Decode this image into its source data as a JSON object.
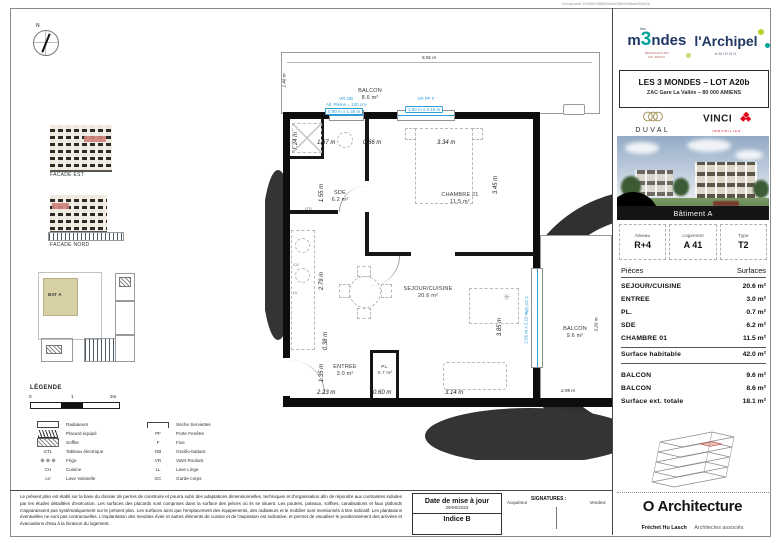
{
  "doc_ref": "Docaposte 209d9e2f8866/e6c0f8e99e8a8d93d2b",
  "branding": {
    "mondes_prefix": "m",
    "mondes_digit": "3",
    "mondes_suffix": "ndes",
    "mondes_les": "les",
    "mondes_tagline1": "DESTINATION",
    "mondes_tagline2": "DU M3CO",
    "archipel": "l'Archipel",
    "archipel_city": "AMIENS",
    "duval": "DUVAL",
    "vinci": "VINCI",
    "vinci_sub": "IMMOBILIER"
  },
  "title_block": {
    "line1": "LES 3 MONDES – LOT A20b",
    "line2": "ZAC Gare La Vallée – 80 000 AMIENS"
  },
  "photo": {
    "caption": "Bâtiment A"
  },
  "unit": {
    "headers": [
      "Niveau",
      "Logement",
      "Type"
    ],
    "values": [
      "R+4",
      "A 41",
      "T2"
    ]
  },
  "surfaces": {
    "header_left": "Pièces",
    "header_right": "Surfaces",
    "rows": [
      {
        "label": "SEJOUR/CUISINE",
        "value": "20.6 m²"
      },
      {
        "label": "ENTREE",
        "value": "3.0 m²"
      },
      {
        "label": "PL.",
        "value": "0.7 m²"
      },
      {
        "label": "SDE",
        "value": "6.2 m²"
      },
      {
        "label": "CHAMBRE 01",
        "value": "11.5 m²"
      }
    ],
    "total": {
      "label": "Surface habitable",
      "value": "42.0 m²"
    },
    "ext_rows": [
      {
        "label": "BALCON",
        "value": "9.6 m²"
      },
      {
        "label": "BALCON",
        "value": "8.6 m²"
      }
    ],
    "ext_total": {
      "label": "Surface ext. totale",
      "value": "18.1 m²"
    }
  },
  "plan": {
    "rooms": {
      "balcon_top": {
        "name": "BALCON",
        "area": "8.6 m²"
      },
      "sde": {
        "name": "SDE",
        "area": "6.2 m²"
      },
      "chambre": {
        "name": "CHAMBRE 01",
        "area": "11.5 m²"
      },
      "sejour": {
        "name": "SEJOUR/CUISINE",
        "area": "20.6 m²"
      },
      "entree": {
        "name": "ENTREE",
        "area": "3.0 m²"
      },
      "placard": {
        "name": "PL.",
        "area": "0.7 m²"
      },
      "balcon_right": {
        "name": "BALCON",
        "area": "9.6 m²"
      }
    },
    "dims": {
      "balcon_top_w": "5.91 m",
      "balcon_top_d": "1.46 m",
      "sde_w": "1.87 m",
      "hall_w": "0.66 m",
      "chambre_w": "3.34 m",
      "bath_w": "1.24 m",
      "sde_h": "1.55 m",
      "chambre_h": "3.45 m",
      "kitchen_h": "2.79 m",
      "mid_h": "0.38 m",
      "entree_h": "1.35 m",
      "entree_w": "2.23 m",
      "pl_w": "0.60 m",
      "sejour_w": "3.14 m",
      "sejour_h": "3.85 m",
      "balcon_right_h": "3.26 m",
      "balcon_right_w": "2.95 m"
    },
    "windows": {
      "w1_codes": "VR OB",
      "w1_allege": "All. Pleine = 100 cm",
      "w1_size": "0.90 m x 1.35 m",
      "w2_codes": "VR PF F",
      "w2_size": "1.80 m x 2.15 m",
      "w3_codes": "VR PF F",
      "w3_size": "2.05 m x 2.15 m"
    },
    "labels": {
      "gtl": "GTL",
      "cu": "CU",
      "lv": "LV"
    }
  },
  "left_panel": {
    "compass_n": "N",
    "facade_est": "FACADE EST",
    "facade_nord": "FACADE NORD",
    "site_building": "BAT A"
  },
  "legend": {
    "title": "LÉGENDE",
    "scale": {
      "zero": "0",
      "one": "1",
      "two": "2m"
    },
    "frigo_symbol": "⊛ ⊛ ⊛",
    "left": [
      {
        "code": "",
        "label": "Radiateurs"
      },
      {
        "code": "",
        "label": "Placard équipé"
      },
      {
        "code": "",
        "label": "Soffite"
      },
      {
        "code": "GTL",
        "label": "Tableau électrique"
      },
      {
        "code": "",
        "label": "Frigo"
      },
      {
        "code": "CU",
        "label": "Cuisine"
      },
      {
        "code": "LV",
        "label": "Lave Vaisselle"
      }
    ],
    "right": [
      {
        "code": "",
        "label": "Sèche Serviettes"
      },
      {
        "code": "PF",
        "label": "Porte Fenêtre"
      },
      {
        "code": "F",
        "label": "Fixe"
      },
      {
        "code": "OB",
        "label": "Oscillo-battant"
      },
      {
        "code": "VR",
        "label": "Volet Roulant"
      },
      {
        "code": "LL",
        "label": "Lave Linge"
      },
      {
        "code": "GC",
        "label": "Garde-corps"
      }
    ]
  },
  "footer": {
    "legal": "Le présent plan est établi sur la base du dossier de permis de construire et pourra subir des adaptations dimensionnelles, techniques et d'organisation afin de répondre aux contraintes induites par les études détaillées d'exécution. Les surfaces des placards sont comprises dans la surface des pièces où ils se situent. Les poutres, poteaux, soffites, canalisations et faux plafonds n'apparaissent pas systématiquement sur le présent plan. Les surfaces ainsi que l'emplacement des équipements, des radiateurs et le mobilier sont mentionnés à titre indicatif. Les plantations éventuelles ne sont pas contractuelles. L'implantation des meubles évier et autres éléments de cuisine et de l'aspiration est indicative, et permet de visualiser le positionnement des arrivées et évacuations d'eau à la livraison du logement.",
    "date_label": "Date de mise à jour",
    "date_value": "29/06/2023",
    "indice": "Indice B",
    "signatures_label": "SIGNATURES :",
    "buyer": "Acquéreur",
    "seller": "Vendeur"
  },
  "architect": {
    "name": "O Architecture",
    "partners": "Fréchet Hu Lasch",
    "suffix": "Architectes associés"
  },
  "colors": {
    "annotation_blue": "#2d9fd6",
    "navy": "#1f3864",
    "teal": "#00a39a",
    "vinci_red": "#e2001a",
    "duval_gold": "#a5915a",
    "site_beige": "#d6d0a4",
    "facade_highlight": "#cf8279"
  }
}
